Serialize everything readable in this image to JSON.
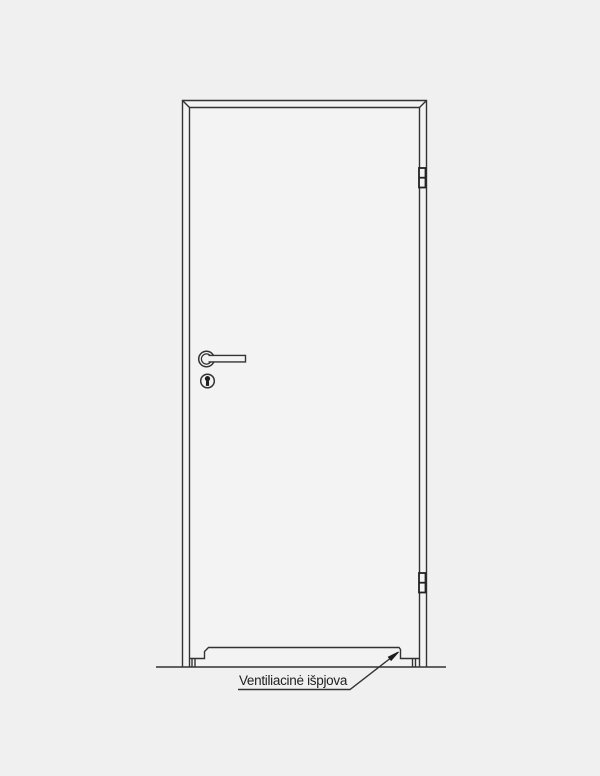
{
  "canvas": {
    "background_color": "#f0f0f0",
    "door_fill_color": "#f3f3f3",
    "line_color": "#333333",
    "hinge_line_color": "#222222"
  },
  "annotation": {
    "label": "Ventiliacinė išpjova"
  },
  "parts": [
    {
      "name": "floor-line"
    },
    {
      "name": "door-frame"
    },
    {
      "name": "door-leaf"
    },
    {
      "name": "top-hinge"
    },
    {
      "name": "bottom-hinge"
    },
    {
      "name": "lever-handle"
    },
    {
      "name": "keyhole-escutcheon"
    },
    {
      "name": "ventilation-cutout"
    },
    {
      "name": "leader-arrow"
    }
  ]
}
